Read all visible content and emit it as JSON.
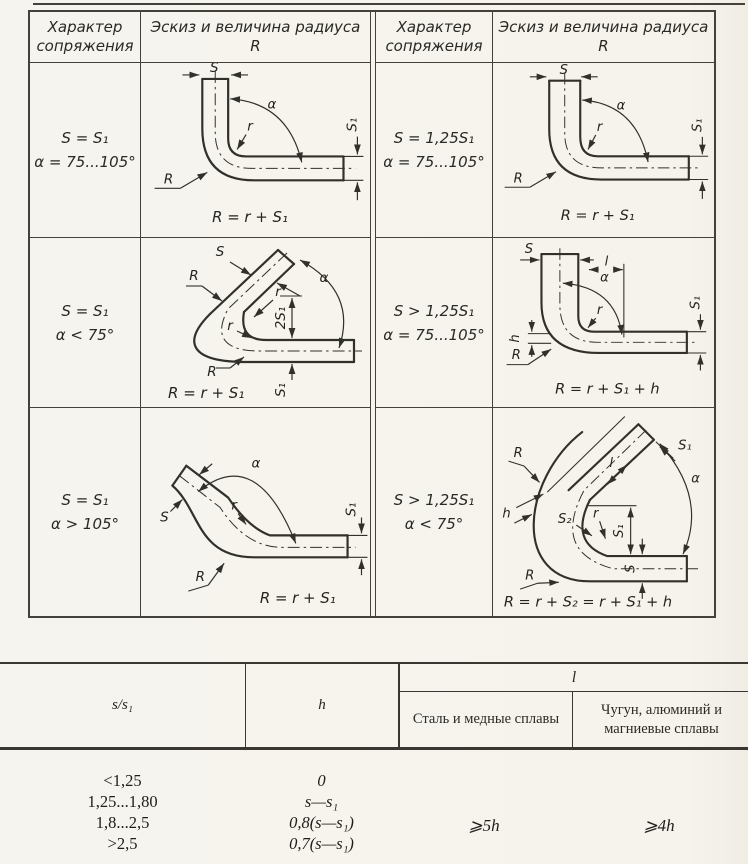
{
  "diagram_table": {
    "header_character": "Характер сопряжения",
    "header_sketch": "Эскиз и величина радиуса R",
    "cells": [
      {
        "condition": [
          "S = S₁",
          "α = 75...105°"
        ],
        "formula": "R = r + S₁",
        "labels": {
          "s": "S",
          "alpha": "α",
          "r": "r",
          "R": "R",
          "s1": "S₁"
        }
      },
      {
        "condition": [
          "S = 1,25S₁",
          "α = 75...105°"
        ],
        "formula": "R = r + S₁",
        "labels": {
          "s": "S",
          "alpha": "α",
          "r": "r",
          "R": "R",
          "s1": "S₁"
        }
      },
      {
        "condition": [
          "S = S₁",
          "α < 75°"
        ],
        "formula": "R = r + S₁",
        "labels": {
          "s": "S",
          "alpha": "α",
          "r": "r",
          "r2": "r",
          "R": "R",
          "R2": "R",
          "two_s1": "2S₁",
          "s1": "S₁"
        }
      },
      {
        "condition": [
          "S > 1,25S₁",
          "α = 75...105°"
        ],
        "formula": "R = r + S₁ + h",
        "labels": {
          "s": "S",
          "l": "l",
          "alpha": "α",
          "r": "r",
          "h": "h",
          "R": "R",
          "s1": "S₁"
        }
      },
      {
        "condition": [
          "S = S₁",
          "α > 105°"
        ],
        "formula": "R = r + S₁",
        "labels": {
          "s": "S",
          "alpha": "α",
          "r": "r",
          "R": "R",
          "s1": "S₁"
        }
      },
      {
        "condition": [
          "S > 1,25S₁",
          "α < 75°"
        ],
        "formula": "R = r + S₂ = r + S₁ + h",
        "labels": {
          "s1_arm": "S₁",
          "R": "R",
          "R2": "R",
          "alpha": "α",
          "l": "l",
          "h": "h",
          "s2": "S₂",
          "r": "r",
          "s1": "S₁",
          "s": "S"
        }
      }
    ]
  },
  "lower_table": {
    "headers": {
      "ratio": "s/s₁",
      "h": "h",
      "l": "l",
      "steel": "Сталь и медные сплавы",
      "cast": "Чугун, алюминий и магниевые сплавы"
    },
    "rows": [
      {
        "ratio": "<1,25",
        "h": "0"
      },
      {
        "ratio": "1,25...1,80",
        "h": "s—s₁"
      },
      {
        "ratio": "1,8...2,5",
        "h": "0,8(s—s₁)"
      },
      {
        "ratio": ">2,5",
        "h": "0,7(s—s₁)"
      }
    ],
    "l_steel": "⩾5h",
    "l_cast": "⩾4h"
  }
}
